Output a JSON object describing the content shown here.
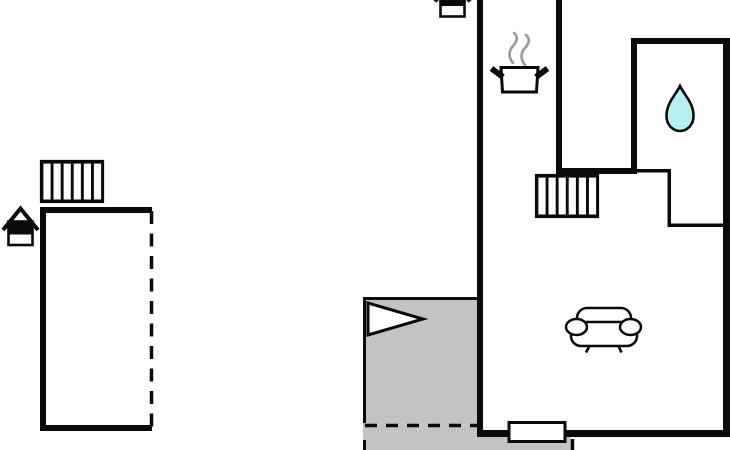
{
  "plan": {
    "type": "apartment-floor-plan",
    "colors": {
      "background": "#ffffff",
      "line": "#0a0a0a",
      "terrace_fill": "#c3c3c3",
      "water_drop_fill": "#b6f0f1",
      "steam_stroke": "#9a9a9a"
    },
    "rooms": {
      "left_annex": {
        "heater": "radiator-icon",
        "entrance_marker": "house-entrance-icon",
        "open_side": "dashed"
      },
      "kitchen": {
        "icon": "cooking-pot-icon"
      },
      "bathroom": {
        "icon": "water-drop-icon"
      },
      "living_room": {
        "icon": "sofa-icon",
        "heater": "radiator-icon",
        "door": "door-opening"
      },
      "terrace": {
        "icon": "entrance-arrow-icon",
        "boundary": "dashed"
      }
    },
    "radiator_cells": 6
  }
}
